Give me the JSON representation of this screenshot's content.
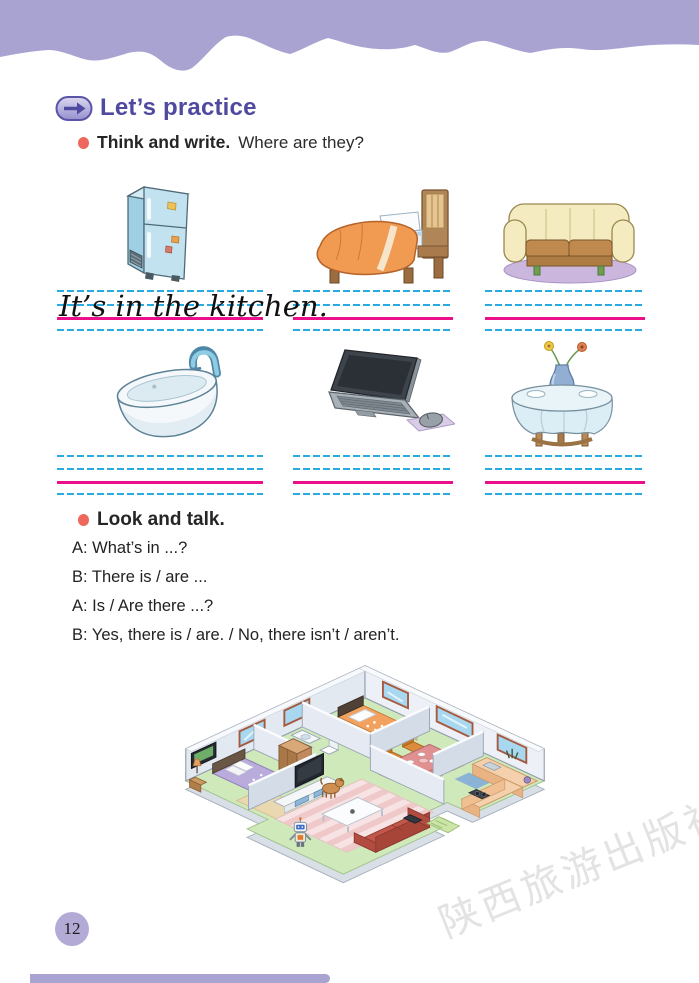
{
  "page": {
    "number": "12",
    "watermark": "陕西旅游出版社"
  },
  "colors": {
    "band": "#a9a3d2",
    "heading": "#4f4aa0",
    "bullet": "#ee675c",
    "guide_line_blue": "#29abe2",
    "guide_line_pink": "#ec0f8c"
  },
  "header": {
    "icon": "arrow-right",
    "title": "Let’s practice"
  },
  "think_and_write": {
    "label": "Think and write.",
    "prompt": "Where are they?",
    "cells": [
      {
        "item": "refrigerator",
        "answer": "It’s in the kitchen."
      },
      {
        "item": "bed",
        "answer": ""
      },
      {
        "item": "sofa",
        "answer": ""
      },
      {
        "item": "bathtub",
        "answer": ""
      },
      {
        "item": "laptop",
        "answer": ""
      },
      {
        "item": "round table",
        "answer": ""
      }
    ]
  },
  "look_and_talk": {
    "label": "Look and talk.",
    "dialogue": [
      "A: What’s in ...?",
      "B: There is / are ...",
      "A: Is / Are there ...?",
      "B: Yes, there is / are. / No, there isn’t / aren’t."
    ]
  }
}
